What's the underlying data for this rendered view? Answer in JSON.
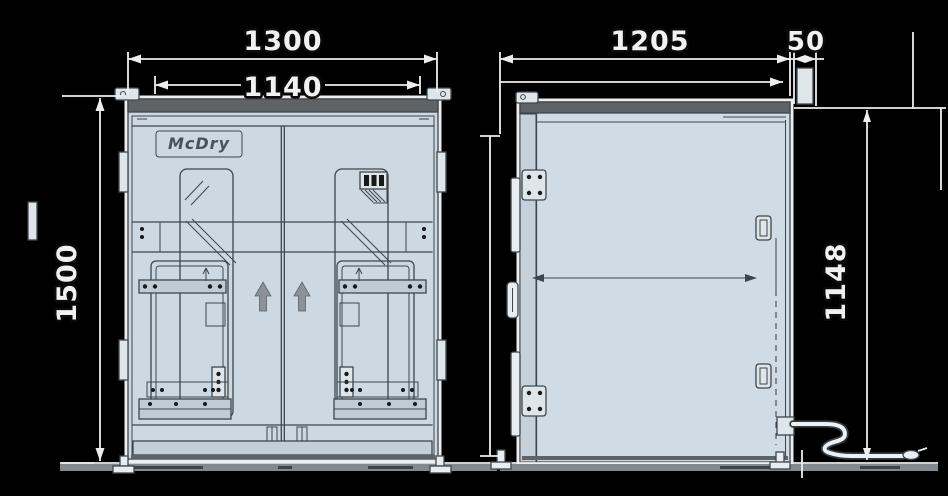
{
  "brand": {
    "label": "McDry"
  },
  "dimensions": {
    "front": {
      "outer_width": "1300",
      "inner_width": "1140",
      "height": "1500"
    },
    "side": {
      "depth": "1205",
      "rear_gap": "50",
      "rear_height": "1148"
    }
  },
  "icons": {
    "door_direction": "up-arrow",
    "power_cord_end": "cord-plug"
  },
  "colors": {
    "background": "#000000",
    "body_fill": "#ccd8e2",
    "body_fill_alt": "#d0dce5",
    "line": "#3e464c",
    "top_strip": "#5d6367",
    "dim_line": "#ededed",
    "dim_text": "#f1f1f1",
    "ground_strip": "#84898d",
    "arrow_fill": "#8b9298",
    "logo_text": "#49525a"
  }
}
